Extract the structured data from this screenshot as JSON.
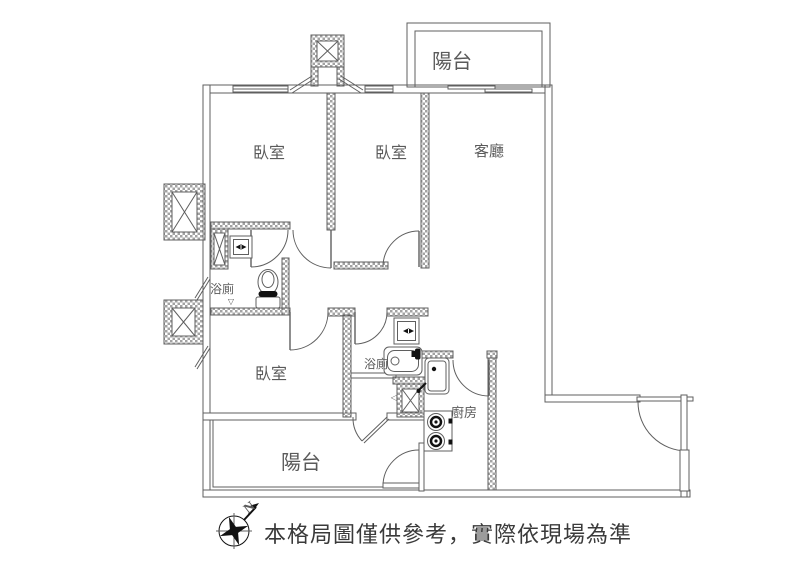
{
  "plan": {
    "rooms": {
      "balcony_top": "陽台",
      "bedroom1": "臥室",
      "bedroom2": "臥室",
      "living": "客廳",
      "bath1": "浴廁",
      "bedroom3": "臥室",
      "bath2": "浴廁",
      "kitchen": "廚房",
      "balcony_bottom": "陽台"
    },
    "markers": {
      "drain": "▽",
      "vent": "◁",
      "north": "N"
    },
    "disclaimer": "本格局圖僅供參考，實際依現場為準",
    "colors": {
      "line": "#5f5f5f",
      "hatch": "#a3a3a3",
      "text": "#5a5a5a",
      "ink": "#111111",
      "bg": "#ffffff"
    }
  }
}
